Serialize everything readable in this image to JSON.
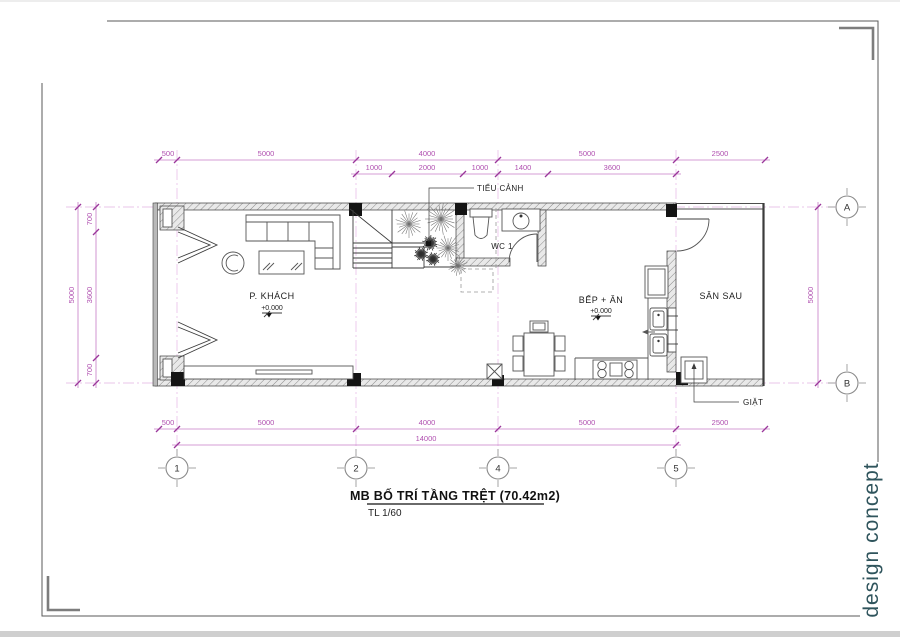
{
  "title": {
    "main": "MB BỐ TRÍ TẦNG TRỆT (70.42m2)",
    "scale": "TL 1/60"
  },
  "branding": {
    "studio": "design concept"
  },
  "rooms": {
    "living": {
      "name": "P. KHÁCH",
      "level": "+0.000"
    },
    "kitchen": {
      "name": "BẾP + ĂN",
      "level": "+0.000"
    },
    "wc": {
      "name": "WC 1"
    },
    "backyard": {
      "name": "SÂN SAU"
    }
  },
  "annotations": {
    "garden": "TIỂU CẢNH",
    "laundry": "GIẶT"
  },
  "grid": {
    "cols": [
      "1",
      "2",
      "4",
      "5"
    ],
    "rows": [
      "A",
      "B"
    ]
  },
  "dims": {
    "top_main": [
      "500",
      "5000",
      "4000",
      "5000",
      "2500"
    ],
    "top_sub": [
      "1000",
      "2000",
      "1000",
      "1400",
      "3600"
    ],
    "bottom_main": [
      "500",
      "5000",
      "4000",
      "5000",
      "2500"
    ],
    "bottom_total": "14000",
    "left_outer": "5000",
    "left_sub": [
      "700",
      "3600",
      "700"
    ],
    "right": "5000"
  },
  "colors": {
    "dimension": "#b050b0",
    "grid_line": "#eac6ea",
    "brand": "#2f545c",
    "drawing": "#3c3c3c"
  }
}
